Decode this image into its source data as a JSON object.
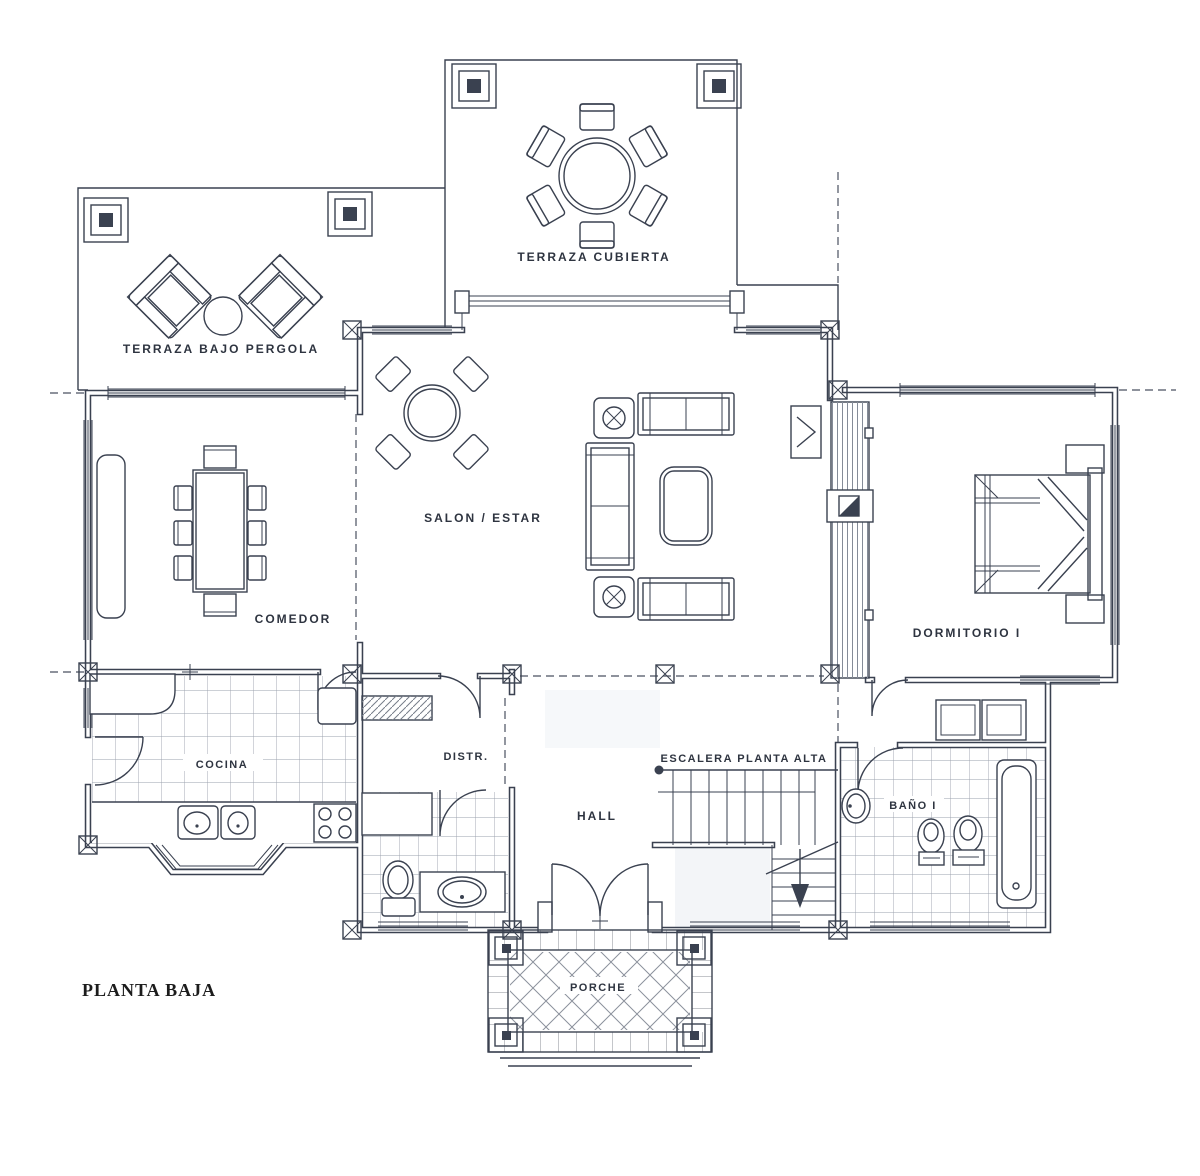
{
  "title": "PLANTA BAJA",
  "colors": {
    "ink": "#3a4150",
    "paper": "#ffffff",
    "tile_line": "#9aa1ac",
    "scan_tint": "#edf0f5"
  },
  "rooms": {
    "terraza_cubierta": {
      "label": "TERRAZA CUBIERTA"
    },
    "terraza_pergola": {
      "label": "TERRAZA BAJO PERGOLA"
    },
    "salon": {
      "label": "SALON / ESTAR"
    },
    "comedor": {
      "label": "COMEDOR"
    },
    "dormitorio": {
      "label": "DORMITORIO I"
    },
    "cocina": {
      "label": "COCINA"
    },
    "distribuidor": {
      "label": "DISTR."
    },
    "hall": {
      "label": "HALL"
    },
    "escalera": {
      "label": "ESCALERA PLANTA ALTA"
    },
    "bano": {
      "label": "BAÑO I"
    },
    "porche": {
      "label": "PORCHE"
    }
  }
}
